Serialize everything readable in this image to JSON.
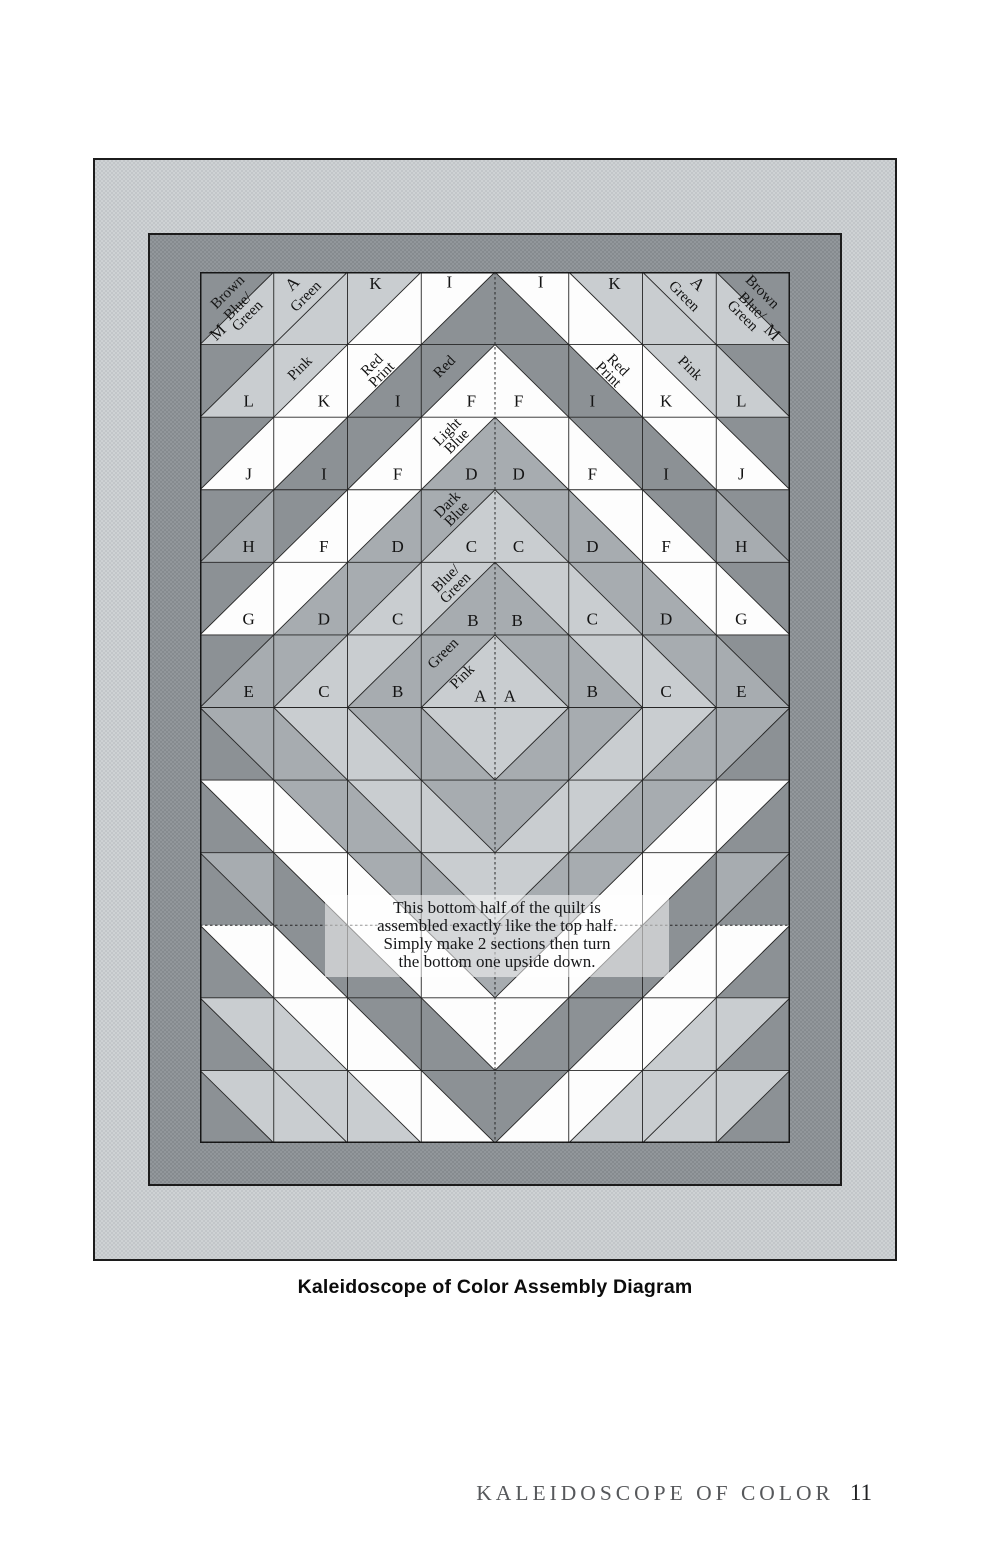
{
  "title_caption": "Kaleidoscope of Color Assembly Diagram",
  "footer": {
    "title": "KALEIDOSCOPE OF COLOR",
    "page": "11"
  },
  "note": {
    "lines": [
      "This bottom half of the quilt is",
      "assembled exactly like the top half.",
      "Simply make 2 sections then turn",
      "the bottom one upside down."
    ]
  },
  "palette": {
    "white": "#fdfdfd",
    "light": "#c9cdd0",
    "medium": "#a7acb0",
    "dark": "#8c9195",
    "line": "#262626",
    "outline": "#161616",
    "label_ink": "#141414"
  },
  "quilt": {
    "cols": 8,
    "rows": 12,
    "width": 590,
    "height": 871,
    "tone_names": {
      "W": "white",
      "L": "light-gray",
      "M": "medium-gray",
      "D": "dark-gray"
    },
    "dashed_center_column": true,
    "dashed_row_boundary": 9,
    "cells": [
      {
        "r": 1,
        "c": 1,
        "d": "/",
        "a": "D",
        "b": "L",
        "lab": [
          [
            "Brown",
            38,
            28,
            -45
          ],
          [
            "M",
            24,
            83,
            -45
          ],
          [
            "Blue/\nGreen",
            58,
            54,
            -45
          ]
        ]
      },
      {
        "r": 1,
        "c": 2,
        "d": "/",
        "a": "L",
        "b": "L",
        "lab": [
          [
            "A",
            25,
            16,
            -45
          ],
          [
            "Green",
            44,
            34,
            -45
          ]
        ]
      },
      {
        "r": 1,
        "c": 3,
        "d": "/",
        "a": "L",
        "b": "W",
        "lab": [
          [
            "K",
            38,
            16,
            0
          ]
        ]
      },
      {
        "r": 1,
        "c": 4,
        "d": "/",
        "a": "W",
        "b": "D",
        "lab": [
          [
            "I",
            38,
            14,
            0
          ]
        ]
      },
      {
        "r": 1,
        "c": 5,
        "d": "\\",
        "a": "W",
        "b": "D",
        "lab": [
          [
            "I",
            62,
            14,
            0
          ]
        ]
      },
      {
        "r": 1,
        "c": 6,
        "d": "\\",
        "a": "L",
        "b": "W",
        "lab": [
          [
            "K",
            62,
            16,
            0
          ]
        ]
      },
      {
        "r": 1,
        "c": 7,
        "d": "\\",
        "a": "L",
        "b": "L",
        "lab": [
          [
            "A",
            75,
            16,
            45
          ],
          [
            "Green",
            56,
            34,
            45
          ]
        ]
      },
      {
        "r": 1,
        "c": 8,
        "d": "\\",
        "a": "D",
        "b": "L",
        "lab": [
          [
            "Brown",
            62,
            28,
            45
          ],
          [
            "Blue/\nGreen",
            42,
            54,
            45
          ],
          [
            "M",
            76,
            83,
            45
          ]
        ]
      },
      {
        "r": 2,
        "c": 1,
        "d": "/",
        "a": "D",
        "b": "L",
        "lab": [
          [
            "L",
            66,
            78,
            0
          ]
        ]
      },
      {
        "r": 2,
        "c": 2,
        "d": "/",
        "a": "L",
        "b": "W",
        "lab": [
          [
            "Pink",
            36,
            33,
            -45
          ],
          [
            "K",
            68,
            78,
            0
          ]
        ]
      },
      {
        "r": 2,
        "c": 3,
        "d": "/",
        "a": "W",
        "b": "D",
        "lab": [
          [
            "Red\nPrint",
            40,
            35,
            -45
          ],
          [
            "I",
            68,
            78,
            0
          ]
        ]
      },
      {
        "r": 2,
        "c": 4,
        "d": "/",
        "a": "D",
        "b": "W",
        "lab": [
          [
            "Red",
            32,
            31,
            -45
          ],
          [
            "F",
            68,
            78,
            0
          ]
        ]
      },
      {
        "r": 2,
        "c": 5,
        "d": "\\",
        "a": "D",
        "b": "W",
        "lab": [
          [
            "F",
            32,
            78,
            0
          ]
        ]
      },
      {
        "r": 2,
        "c": 6,
        "d": "\\",
        "a": "W",
        "b": "D",
        "lab": [
          [
            "Red\nPrint",
            60,
            35,
            45
          ],
          [
            "I",
            32,
            78,
            0
          ]
        ]
      },
      {
        "r": 2,
        "c": 7,
        "d": "\\",
        "a": "L",
        "b": "W",
        "lab": [
          [
            "Pink",
            64,
            33,
            45
          ],
          [
            "K",
            32,
            78,
            0
          ]
        ]
      },
      {
        "r": 2,
        "c": 8,
        "d": "\\",
        "a": "D",
        "b": "L",
        "lab": [
          [
            "L",
            34,
            78,
            0
          ]
        ]
      },
      {
        "r": 3,
        "c": 1,
        "d": "/",
        "a": "D",
        "b": "W",
        "lab": [
          [
            "J",
            66,
            78,
            0
          ]
        ]
      },
      {
        "r": 3,
        "c": 2,
        "d": "/",
        "a": "W",
        "b": "D",
        "lab": [
          [
            "I",
            68,
            78,
            0
          ]
        ]
      },
      {
        "r": 3,
        "c": 3,
        "d": "/",
        "a": "D",
        "b": "W",
        "lab": [
          [
            "F",
            68,
            78,
            0
          ]
        ]
      },
      {
        "r": 3,
        "c": 4,
        "d": "/",
        "a": "W",
        "b": "M",
        "lab": [
          [
            "Light\nBlue",
            42,
            27,
            -45
          ],
          [
            "D",
            68,
            78,
            0
          ]
        ]
      },
      {
        "r": 3,
        "c": 5,
        "d": "\\",
        "a": "W",
        "b": "M",
        "lab": [
          [
            "D",
            32,
            78,
            0
          ]
        ]
      },
      {
        "r": 3,
        "c": 6,
        "d": "\\",
        "a": "D",
        "b": "W",
        "lab": [
          [
            "F",
            32,
            78,
            0
          ]
        ]
      },
      {
        "r": 3,
        "c": 7,
        "d": "\\",
        "a": "W",
        "b": "D",
        "lab": [
          [
            "I",
            32,
            78,
            0
          ]
        ]
      },
      {
        "r": 3,
        "c": 8,
        "d": "\\",
        "a": "D",
        "b": "W",
        "lab": [
          [
            "J",
            34,
            78,
            0
          ]
        ]
      },
      {
        "r": 4,
        "c": 1,
        "d": "/",
        "a": "D",
        "b": "M",
        "lab": [
          [
            "H",
            66,
            78,
            0
          ]
        ]
      },
      {
        "r": 4,
        "c": 2,
        "d": "/",
        "a": "D",
        "b": "W",
        "lab": [
          [
            "F",
            68,
            78,
            0
          ]
        ]
      },
      {
        "r": 4,
        "c": 3,
        "d": "/",
        "a": "W",
        "b": "M",
        "lab": [
          [
            "D",
            68,
            78,
            0
          ]
        ]
      },
      {
        "r": 4,
        "c": 4,
        "d": "/",
        "a": "M",
        "b": "L",
        "lab": [
          [
            "Dark\nBlue",
            42,
            27,
            -45
          ],
          [
            "C",
            68,
            78,
            0
          ]
        ]
      },
      {
        "r": 4,
        "c": 5,
        "d": "\\",
        "a": "M",
        "b": "L",
        "lab": [
          [
            "C",
            32,
            78,
            0
          ]
        ]
      },
      {
        "r": 4,
        "c": 6,
        "d": "\\",
        "a": "W",
        "b": "M",
        "lab": [
          [
            "D",
            32,
            78,
            0
          ]
        ]
      },
      {
        "r": 4,
        "c": 7,
        "d": "\\",
        "a": "D",
        "b": "W",
        "lab": [
          [
            "F",
            32,
            78,
            0
          ]
        ]
      },
      {
        "r": 4,
        "c": 8,
        "d": "\\",
        "a": "D",
        "b": "M",
        "lab": [
          [
            "H",
            34,
            78,
            0
          ]
        ]
      },
      {
        "r": 5,
        "c": 1,
        "d": "/",
        "a": "D",
        "b": "W",
        "lab": [
          [
            "G",
            66,
            78,
            0
          ]
        ]
      },
      {
        "r": 5,
        "c": 2,
        "d": "/",
        "a": "W",
        "b": "M",
        "lab": [
          [
            "D",
            68,
            78,
            0
          ]
        ]
      },
      {
        "r": 5,
        "c": 3,
        "d": "/",
        "a": "M",
        "b": "L",
        "lab": [
          [
            "C",
            68,
            78,
            0
          ]
        ]
      },
      {
        "r": 5,
        "c": 4,
        "d": "/",
        "a": "L",
        "b": "M",
        "lab": [
          [
            "Blue/\nGreen",
            40,
            29,
            -45
          ],
          [
            "B",
            70,
            80,
            0
          ]
        ]
      },
      {
        "r": 5,
        "c": 5,
        "d": "\\",
        "a": "L",
        "b": "M",
        "lab": [
          [
            "B",
            30,
            80,
            0
          ]
        ]
      },
      {
        "r": 5,
        "c": 6,
        "d": "\\",
        "a": "M",
        "b": "L",
        "lab": [
          [
            "C",
            32,
            78,
            0
          ]
        ]
      },
      {
        "r": 5,
        "c": 7,
        "d": "\\",
        "a": "W",
        "b": "M",
        "lab": [
          [
            "D",
            32,
            78,
            0
          ]
        ]
      },
      {
        "r": 5,
        "c": 8,
        "d": "\\",
        "a": "D",
        "b": "W",
        "lab": [
          [
            "G",
            34,
            78,
            0
          ]
        ]
      },
      {
        "r": 6,
        "c": 1,
        "d": "/",
        "a": "D",
        "b": "M",
        "lab": [
          [
            "E",
            66,
            78,
            0
          ]
        ]
      },
      {
        "r": 6,
        "c": 2,
        "d": "/",
        "a": "M",
        "b": "L",
        "lab": [
          [
            "C",
            68,
            78,
            0
          ]
        ]
      },
      {
        "r": 6,
        "c": 3,
        "d": "/",
        "a": "L",
        "b": "M",
        "lab": [
          [
            "B",
            68,
            78,
            0
          ]
        ]
      },
      {
        "r": 6,
        "c": 4,
        "d": "/",
        "a": "M",
        "b": "L",
        "lab": [
          [
            "Green",
            30,
            26,
            -45
          ],
          [
            "Pink",
            56,
            58,
            -45
          ],
          [
            "A",
            80,
            84,
            0
          ]
        ]
      },
      {
        "r": 6,
        "c": 5,
        "d": "\\",
        "a": "M",
        "b": "L",
        "lab": [
          [
            "A",
            20,
            84,
            0
          ]
        ]
      },
      {
        "r": 6,
        "c": 6,
        "d": "\\",
        "a": "L",
        "b": "M",
        "lab": [
          [
            "B",
            32,
            78,
            0
          ]
        ]
      },
      {
        "r": 6,
        "c": 7,
        "d": "\\",
        "a": "M",
        "b": "L",
        "lab": [
          [
            "C",
            32,
            78,
            0
          ]
        ]
      },
      {
        "r": 6,
        "c": 8,
        "d": "\\",
        "a": "D",
        "b": "M",
        "lab": [
          [
            "E",
            34,
            78,
            0
          ]
        ]
      },
      {
        "r": 7,
        "c": 1,
        "d": "\\",
        "a": "M",
        "b": "D"
      },
      {
        "r": 7,
        "c": 2,
        "d": "\\",
        "a": "L",
        "b": "M"
      },
      {
        "r": 7,
        "c": 3,
        "d": "\\",
        "a": "M",
        "b": "L"
      },
      {
        "r": 7,
        "c": 4,
        "d": "\\",
        "a": "L",
        "b": "M"
      },
      {
        "r": 7,
        "c": 5,
        "d": "/",
        "a": "L",
        "b": "M"
      },
      {
        "r": 7,
        "c": 6,
        "d": "/",
        "a": "M",
        "b": "L"
      },
      {
        "r": 7,
        "c": 7,
        "d": "/",
        "a": "L",
        "b": "M"
      },
      {
        "r": 7,
        "c": 8,
        "d": "/",
        "a": "M",
        "b": "D"
      },
      {
        "r": 8,
        "c": 1,
        "d": "\\",
        "a": "W",
        "b": "D"
      },
      {
        "r": 8,
        "c": 2,
        "d": "\\",
        "a": "M",
        "b": "W"
      },
      {
        "r": 8,
        "c": 3,
        "d": "\\",
        "a": "L",
        "b": "M"
      },
      {
        "r": 8,
        "c": 4,
        "d": "\\",
        "a": "M",
        "b": "L"
      },
      {
        "r": 8,
        "c": 5,
        "d": "/",
        "a": "M",
        "b": "L"
      },
      {
        "r": 8,
        "c": 6,
        "d": "/",
        "a": "L",
        "b": "M"
      },
      {
        "r": 8,
        "c": 7,
        "d": "/",
        "a": "M",
        "b": "W"
      },
      {
        "r": 8,
        "c": 8,
        "d": "/",
        "a": "W",
        "b": "D"
      },
      {
        "r": 9,
        "c": 1,
        "d": "\\",
        "a": "M",
        "b": "D"
      },
      {
        "r": 9,
        "c": 2,
        "d": "\\",
        "a": "W",
        "b": "D"
      },
      {
        "r": 9,
        "c": 3,
        "d": "\\",
        "a": "M",
        "b": "W"
      },
      {
        "r": 9,
        "c": 4,
        "d": "\\",
        "a": "L",
        "b": "M"
      },
      {
        "r": 9,
        "c": 5,
        "d": "/",
        "a": "L",
        "b": "M"
      },
      {
        "r": 9,
        "c": 6,
        "d": "/",
        "a": "M",
        "b": "W"
      },
      {
        "r": 9,
        "c": 7,
        "d": "/",
        "a": "W",
        "b": "D"
      },
      {
        "r": 9,
        "c": 8,
        "d": "/",
        "a": "M",
        "b": "D"
      },
      {
        "r": 10,
        "c": 1,
        "d": "\\",
        "a": "W",
        "b": "D"
      },
      {
        "r": 10,
        "c": 2,
        "d": "\\",
        "a": "D",
        "b": "W"
      },
      {
        "r": 10,
        "c": 3,
        "d": "\\",
        "a": "W",
        "b": "D"
      },
      {
        "r": 10,
        "c": 4,
        "d": "\\",
        "a": "M",
        "b": "W"
      },
      {
        "r": 10,
        "c": 5,
        "d": "/",
        "a": "M",
        "b": "W"
      },
      {
        "r": 10,
        "c": 6,
        "d": "/",
        "a": "W",
        "b": "D"
      },
      {
        "r": 10,
        "c": 7,
        "d": "/",
        "a": "D",
        "b": "W"
      },
      {
        "r": 10,
        "c": 8,
        "d": "/",
        "a": "W",
        "b": "D"
      },
      {
        "r": 11,
        "c": 1,
        "d": "\\",
        "a": "L",
        "b": "D"
      },
      {
        "r": 11,
        "c": 2,
        "d": "\\",
        "a": "W",
        "b": "L"
      },
      {
        "r": 11,
        "c": 3,
        "d": "\\",
        "a": "D",
        "b": "W"
      },
      {
        "r": 11,
        "c": 4,
        "d": "\\",
        "a": "W",
        "b": "D"
      },
      {
        "r": 11,
        "c": 5,
        "d": "/",
        "a": "W",
        "b": "D"
      },
      {
        "r": 11,
        "c": 6,
        "d": "/",
        "a": "D",
        "b": "W"
      },
      {
        "r": 11,
        "c": 7,
        "d": "/",
        "a": "W",
        "b": "L"
      },
      {
        "r": 11,
        "c": 8,
        "d": "/",
        "a": "L",
        "b": "D"
      },
      {
        "r": 12,
        "c": 1,
        "d": "\\",
        "a": "L",
        "b": "D"
      },
      {
        "r": 12,
        "c": 2,
        "d": "\\",
        "a": "L",
        "b": "L"
      },
      {
        "r": 12,
        "c": 3,
        "d": "\\",
        "a": "W",
        "b": "L"
      },
      {
        "r": 12,
        "c": 4,
        "d": "\\",
        "a": "D",
        "b": "W"
      },
      {
        "r": 12,
        "c": 5,
        "d": "/",
        "a": "D",
        "b": "W"
      },
      {
        "r": 12,
        "c": 6,
        "d": "/",
        "a": "W",
        "b": "L"
      },
      {
        "r": 12,
        "c": 7,
        "d": "/",
        "a": "L",
        "b": "L"
      },
      {
        "r": 12,
        "c": 8,
        "d": "/",
        "a": "L",
        "b": "D"
      }
    ]
  }
}
